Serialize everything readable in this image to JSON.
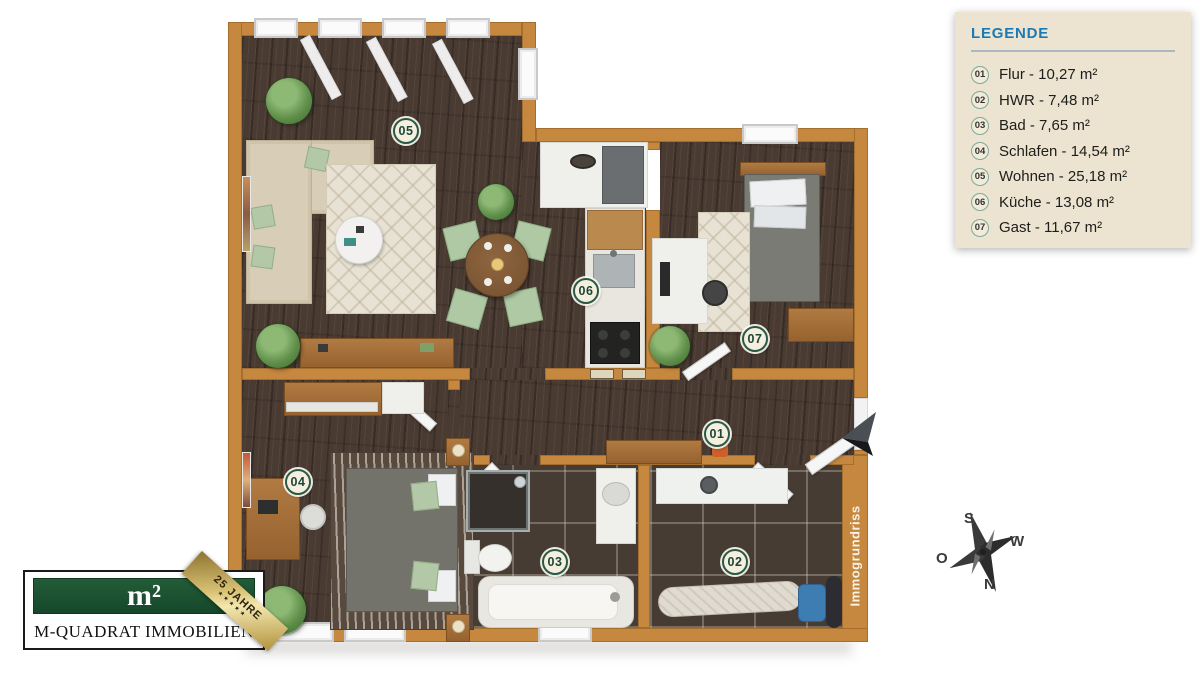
{
  "legend": {
    "title": "LEGENDE",
    "items": [
      {
        "num": "01",
        "text": "Flur - 10,27 m²"
      },
      {
        "num": "02",
        "text": "HWR - 7,48 m²"
      },
      {
        "num": "03",
        "text": "Bad - 7,65 m²"
      },
      {
        "num": "04",
        "text": "Schlafen - 14,54 m²"
      },
      {
        "num": "05",
        "text": "Wohnen - 25,18 m²"
      },
      {
        "num": "06",
        "text": "Küche - 13,08 m²"
      },
      {
        "num": "07",
        "text": "Gast - 11,67 m²"
      }
    ]
  },
  "plan": {
    "watermark": "Immogrundriss"
  },
  "compass": {
    "top": "S",
    "right": "W",
    "bottom": "N",
    "left": "O"
  },
  "logo": {
    "symbol": "m²",
    "name": "M-QUADRAT IMMOBILIEN",
    "ribbon": "25 JAHRE",
    "stars": "★★★★★"
  },
  "colors": {
    "wall_orange": "#c6873f",
    "floor_wood": "#4a3b32",
    "floor_tile": "#463c33",
    "legend_bg": "#ece4d1",
    "legend_blue": "#1b79b5",
    "marker_green": "#2a5a46",
    "logo_green": "#1c5130",
    "ribbon_gold": "#d9c274"
  }
}
